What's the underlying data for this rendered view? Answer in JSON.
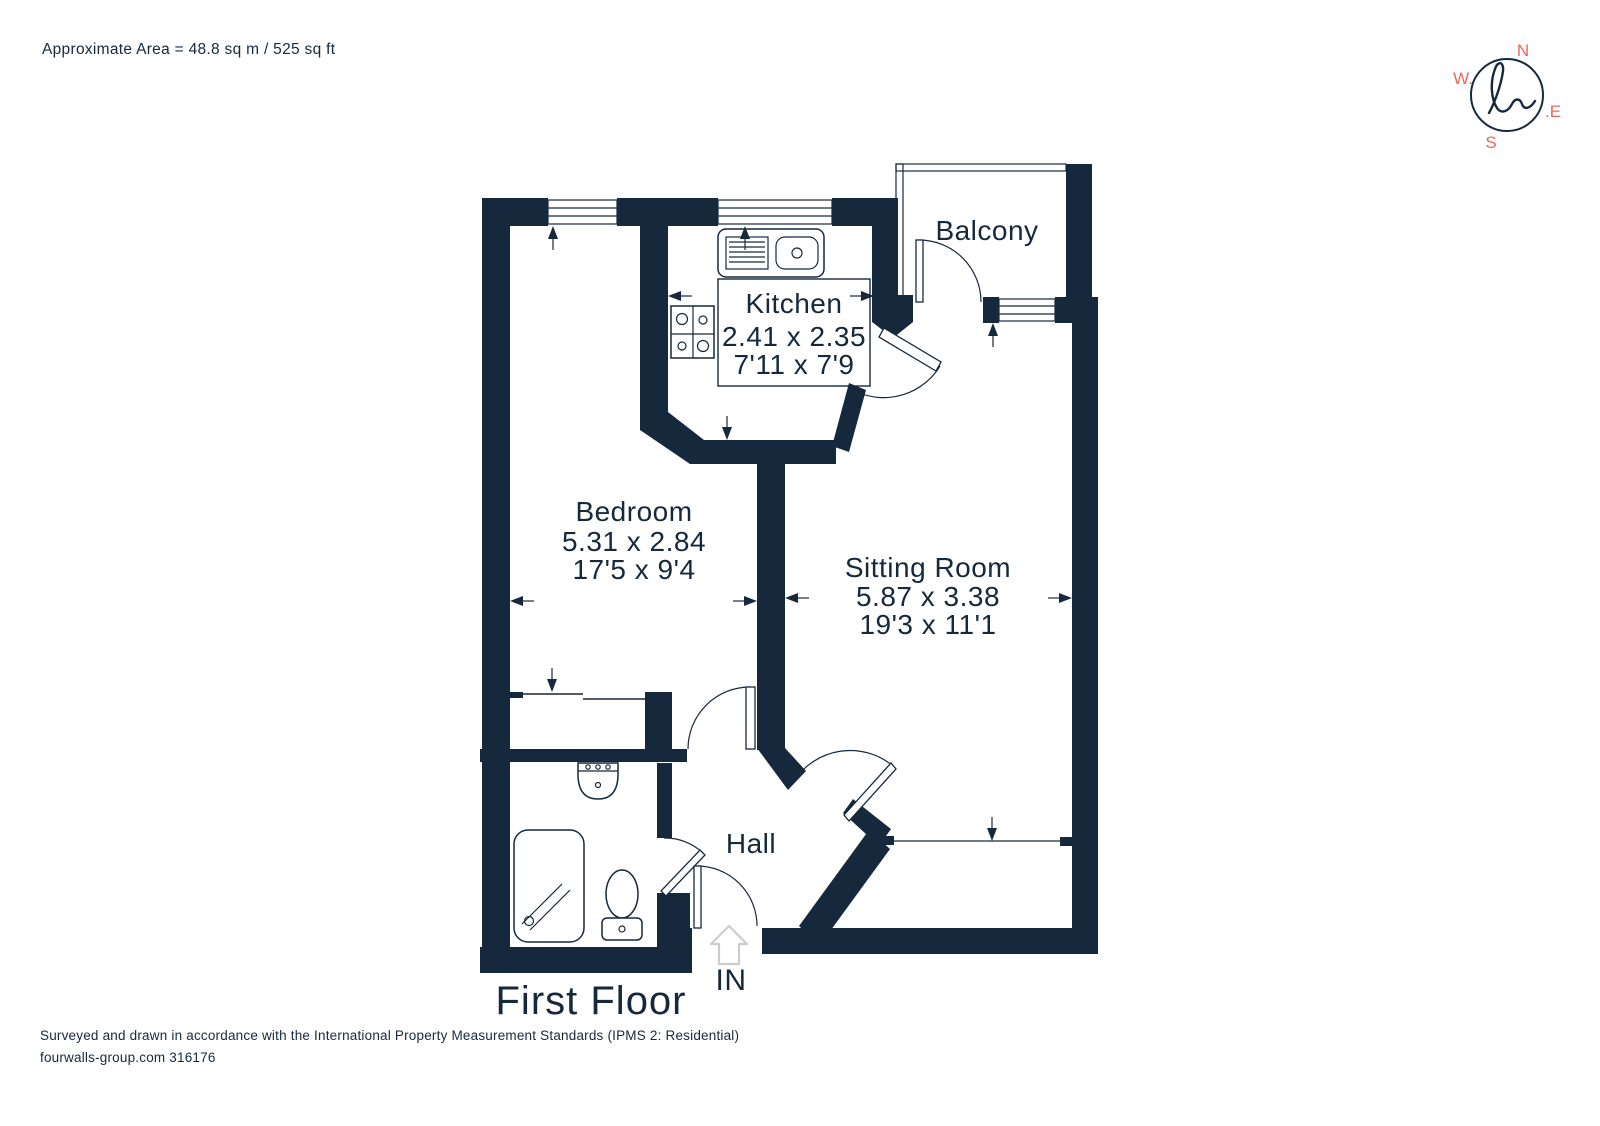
{
  "meta": {
    "approx_area": "Approximate Area = 48.8 sq m / 525 sq ft",
    "floor_title": "First Floor"
  },
  "compass": {
    "north": "N",
    "west": "W.",
    "east": ".E",
    "south": "S",
    "logo_letter": "h"
  },
  "rooms": {
    "balcony": {
      "name": "Balcony"
    },
    "kitchen": {
      "name": "Kitchen",
      "metric": "2.41 x 2.35",
      "imperial": "7'11 x 7'9"
    },
    "bedroom": {
      "name": "Bedroom",
      "metric": "5.31 x 2.84",
      "imperial": "17'5 x 9'4"
    },
    "sitting_room": {
      "name": "Sitting Room",
      "metric": "5.87 x 3.38",
      "imperial": "19'3 x 11'1"
    },
    "hall": {
      "name": "Hall"
    }
  },
  "entrance": {
    "label": "IN"
  },
  "footer": {
    "line1": "Surveyed and drawn in accordance with the International Property Measurement Standards (IPMS 2: Residential)",
    "line2": "fourwalls-group.com 316176"
  },
  "colors": {
    "wall": "#16293c",
    "compass_red": "#e8685d",
    "entry_arrow": "#cccccc"
  }
}
